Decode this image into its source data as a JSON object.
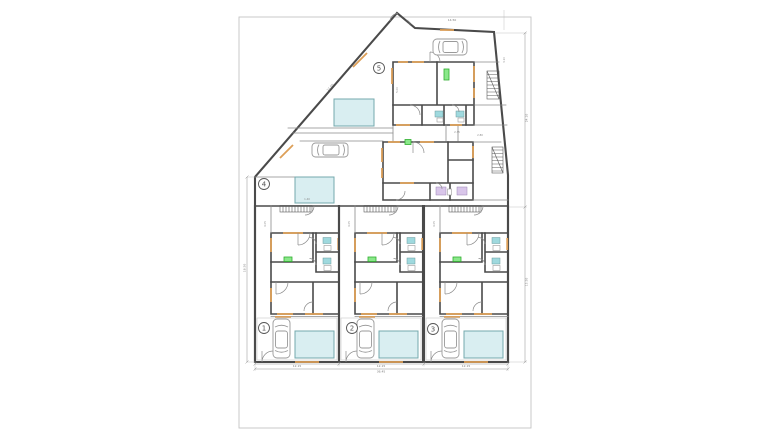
{
  "plan": {
    "type": "architectural-floor-plan",
    "unit_labels": [
      "1",
      "2",
      "3",
      "4",
      "5"
    ],
    "dims": {
      "unit_widths": [
        "12.15",
        "12.15",
        "12.15"
      ],
      "total_width": "36.45",
      "left_height": "18.50",
      "right_upper": "24.10",
      "right_lower": "15.50",
      "diagonal": "21.50",
      "top_edge": "14.50",
      "apex_edge": "4.50",
      "extra": [
        "4.05",
        "4.05",
        "4.05",
        "5.00",
        "2.80",
        "3.10",
        "1.40",
        "2.35"
      ]
    },
    "colors": {
      "paper": "#ffffff",
      "page_border": "#c4c4c4",
      "wall": "#4a4a4a",
      "wall_light": "#8a8a8a",
      "guide": "#c9c9c9",
      "window": "#dd9f57",
      "pool_fill": "#d9eef1",
      "pool_stroke": "#74a8ad",
      "fixture_cyan": "#9fd9de",
      "fixture_purple": "#d9c6ea",
      "door_green_fill": "#8ae88a",
      "door_green_stroke": "#2fae2f",
      "car_stroke": "#9a9a9a",
      "dim": "#8f8f8f"
    }
  }
}
